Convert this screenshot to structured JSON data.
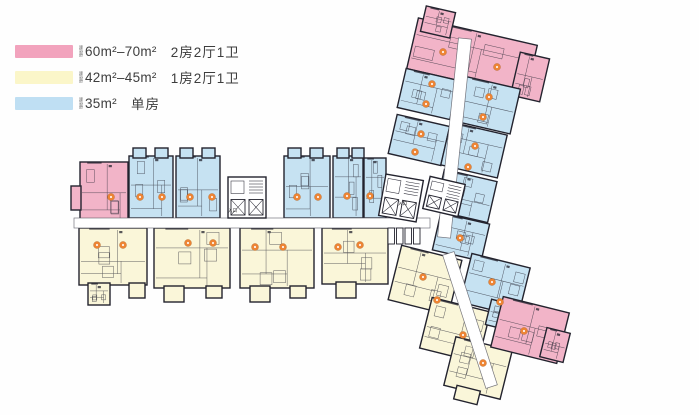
{
  "figure": {
    "kind": "residential-floor-plan",
    "background": "#fefefe"
  },
  "legend": {
    "prefix": "建筑面积",
    "items": [
      {
        "name": "two-bed",
        "swatch_color": "#f2a3bd",
        "area": "60m²–70m²",
        "desc": "2房2厅1卫"
      },
      {
        "name": "one-bed",
        "swatch_color": "#fbf6c9",
        "area": "42m²–45m²",
        "desc": "1房2厅1卫"
      },
      {
        "name": "studio",
        "swatch_color": "#bfdff3",
        "area": "35m²",
        "desc": "单房"
      }
    ]
  },
  "plan": {
    "wall_color": "#23232e",
    "detail_color": "#2c2c38",
    "corridor_color": "#ffffff",
    "marker_color": "#ed8434",
    "unit_colors": {
      "pink": "#f2b4c8",
      "yellow": "#faf6d9",
      "blue": "#c6e2f2",
      "white": "#ffffff"
    },
    "blocks": [
      {
        "k": "u",
        "c": "pink",
        "x": 80,
        "y": 162,
        "w": 48,
        "h": 63,
        "r": 0
      },
      {
        "k": "u",
        "c": "pink",
        "x": 71,
        "y": 186,
        "w": 10,
        "h": 24,
        "r": 0
      },
      {
        "k": "u",
        "c": "blue",
        "x": 129,
        "y": 156,
        "w": 44,
        "h": 62,
        "r": 0
      },
      {
        "k": "u",
        "c": "blue",
        "x": 133,
        "y": 148,
        "w": 13,
        "h": 10,
        "r": 0
      },
      {
        "k": "u",
        "c": "blue",
        "x": 155,
        "y": 148,
        "w": 13,
        "h": 10,
        "r": 0
      },
      {
        "k": "u",
        "c": "blue",
        "x": 176,
        "y": 156,
        "w": 44,
        "h": 62,
        "r": 0
      },
      {
        "k": "u",
        "c": "blue",
        "x": 180,
        "y": 148,
        "w": 13,
        "h": 10,
        "r": 0
      },
      {
        "k": "u",
        "c": "blue",
        "x": 202,
        "y": 148,
        "w": 13,
        "h": 10,
        "r": 0
      },
      {
        "k": "u",
        "c": "blue",
        "x": 284,
        "y": 156,
        "w": 46,
        "h": 62,
        "r": 0
      },
      {
        "k": "u",
        "c": "blue",
        "x": 288,
        "y": 148,
        "w": 13,
        "h": 10,
        "r": 0
      },
      {
        "k": "u",
        "c": "blue",
        "x": 310,
        "y": 148,
        "w": 13,
        "h": 10,
        "r": 0
      },
      {
        "k": "u",
        "c": "blue",
        "x": 333,
        "y": 156,
        "w": 30,
        "h": 62,
        "r": 0
      },
      {
        "k": "u",
        "c": "blue",
        "x": 337,
        "y": 148,
        "w": 12,
        "h": 10,
        "r": 0
      },
      {
        "k": "u",
        "c": "blue",
        "x": 352,
        "y": 148,
        "w": 12,
        "h": 10,
        "r": 0
      },
      {
        "k": "u",
        "c": "blue",
        "x": 364,
        "y": 158,
        "w": 22,
        "h": 60,
        "r": 0
      },
      {
        "k": "u",
        "c": "yellow",
        "x": 79,
        "y": 228,
        "w": 68,
        "h": 57,
        "r": 0
      },
      {
        "k": "u",
        "c": "yellow",
        "x": 88,
        "y": 283,
        "w": 22,
        "h": 22,
        "r": 0
      },
      {
        "k": "u",
        "c": "yellow",
        "x": 129,
        "y": 283,
        "w": 16,
        "h": 15,
        "r": 0
      },
      {
        "k": "u",
        "c": "yellow",
        "x": 154,
        "y": 228,
        "w": 76,
        "h": 60,
        "r": 0
      },
      {
        "k": "u",
        "c": "yellow",
        "x": 164,
        "y": 286,
        "w": 20,
        "h": 16,
        "r": 0
      },
      {
        "k": "u",
        "c": "yellow",
        "x": 206,
        "y": 286,
        "w": 16,
        "h": 12,
        "r": 0
      },
      {
        "k": "u",
        "c": "yellow",
        "x": 240,
        "y": 228,
        "w": 74,
        "h": 60,
        "r": 0
      },
      {
        "k": "u",
        "c": "yellow",
        "x": 250,
        "y": 286,
        "w": 20,
        "h": 16,
        "r": 0
      },
      {
        "k": "u",
        "c": "yellow",
        "x": 290,
        "y": 286,
        "w": 16,
        "h": 12,
        "r": 0
      },
      {
        "k": "u",
        "c": "yellow",
        "x": 322,
        "y": 228,
        "w": 66,
        "h": 56,
        "r": 0
      },
      {
        "k": "u",
        "c": "yellow",
        "x": 336,
        "y": 282,
        "w": 20,
        "h": 16,
        "r": 0
      },
      {
        "k": "u",
        "c": "pink",
        "x": 411,
        "y": 31,
        "w": 122,
        "h": 52,
        "r": 13
      },
      {
        "k": "u",
        "c": "pink",
        "x": 423,
        "y": 9,
        "w": 30,
        "h": 26,
        "r": 13
      },
      {
        "k": "u",
        "c": "pink",
        "x": 515,
        "y": 55,
        "w": 30,
        "h": 44,
        "r": 13
      },
      {
        "k": "u",
        "c": "blue",
        "x": 401,
        "y": 74,
        "w": 54,
        "h": 40,
        "r": 13
      },
      {
        "k": "u",
        "c": "blue",
        "x": 392,
        "y": 120,
        "w": 54,
        "h": 40,
        "r": 13
      },
      {
        "k": "u",
        "c": "blue",
        "x": 458,
        "y": 82,
        "w": 58,
        "h": 46,
        "r": 13
      },
      {
        "k": "u",
        "c": "blue",
        "x": 445,
        "y": 128,
        "w": 58,
        "h": 44,
        "r": 13
      },
      {
        "k": "u",
        "c": "blue",
        "x": 439,
        "y": 175,
        "w": 54,
        "h": 42,
        "r": 13
      },
      {
        "k": "u",
        "c": "blue",
        "x": 436,
        "y": 218,
        "w": 50,
        "h": 38,
        "r": 13
      },
      {
        "k": "u",
        "c": "yellow",
        "x": 394,
        "y": 252,
        "w": 62,
        "h": 56,
        "r": 14
      },
      {
        "k": "u",
        "c": "yellow",
        "x": 425,
        "y": 304,
        "w": 60,
        "h": 52,
        "r": 14
      },
      {
        "k": "u",
        "c": "yellow",
        "x": 449,
        "y": 343,
        "w": 58,
        "h": 50,
        "r": 14
      },
      {
        "k": "u",
        "c": "yellow",
        "x": 455,
        "y": 388,
        "w": 24,
        "h": 14,
        "r": 14
      },
      {
        "k": "u",
        "c": "blue",
        "x": 465,
        "y": 260,
        "w": 60,
        "h": 50,
        "r": 14
      },
      {
        "k": "u",
        "c": "blue",
        "x": 488,
        "y": 303,
        "w": 34,
        "h": 26,
        "r": 14
      },
      {
        "k": "u",
        "c": "pink",
        "x": 496,
        "y": 304,
        "w": 68,
        "h": 52,
        "r": 14
      },
      {
        "k": "u",
        "c": "pink",
        "x": 543,
        "y": 330,
        "w": 24,
        "h": 30,
        "r": 14
      },
      {
        "k": "cor",
        "c": "white",
        "x": 74,
        "y": 218,
        "w": 356,
        "h": 10,
        "r": 0
      },
      {
        "k": "cor",
        "c": "white",
        "x": 448,
        "y": 38,
        "w": 13,
        "h": 200,
        "r": 6
      },
      {
        "k": "cor",
        "c": "white",
        "x": 464,
        "y": 250,
        "w": 12,
        "h": 140,
        "r": -18
      },
      {
        "k": "core",
        "c": "white",
        "x": 228,
        "y": 177,
        "w": 38,
        "h": 41,
        "r": 0
      },
      {
        "k": "core",
        "c": "white",
        "x": 382,
        "y": 177,
        "w": 38,
        "h": 42,
        "r": 10
      },
      {
        "k": "core",
        "c": "white",
        "x": 426,
        "y": 180,
        "w": 36,
        "h": 33,
        "r": 13
      },
      {
        "k": "comb",
        "c": "white",
        "x": 388,
        "y": 228,
        "w": 34,
        "h": 16,
        "r": 0
      }
    ],
    "markers": [
      {
        "x": 111,
        "y": 197
      },
      {
        "x": 140,
        "y": 197
      },
      {
        "x": 162,
        "y": 197
      },
      {
        "x": 190,
        "y": 197
      },
      {
        "x": 212,
        "y": 197
      },
      {
        "x": 297,
        "y": 197
      },
      {
        "x": 318,
        "y": 197
      },
      {
        "x": 347,
        "y": 196
      },
      {
        "x": 370,
        "y": 196
      },
      {
        "x": 97,
        "y": 245
      },
      {
        "x": 123,
        "y": 245
      },
      {
        "x": 188,
        "y": 243
      },
      {
        "x": 213,
        "y": 243
      },
      {
        "x": 255,
        "y": 247
      },
      {
        "x": 283,
        "y": 247
      },
      {
        "x": 338,
        "y": 247
      },
      {
        "x": 360,
        "y": 245
      },
      {
        "x": 443,
        "y": 52
      },
      {
        "x": 497,
        "y": 67
      },
      {
        "x": 432,
        "y": 84
      },
      {
        "x": 426,
        "y": 104
      },
      {
        "x": 421,
        "y": 134
      },
      {
        "x": 415,
        "y": 152
      },
      {
        "x": 489,
        "y": 97
      },
      {
        "x": 483,
        "y": 117
      },
      {
        "x": 475,
        "y": 146
      },
      {
        "x": 468,
        "y": 167
      },
      {
        "x": 460,
        "y": 238
      },
      {
        "x": 423,
        "y": 277
      },
      {
        "x": 437,
        "y": 300
      },
      {
        "x": 463,
        "y": 335
      },
      {
        "x": 483,
        "y": 363
      },
      {
        "x": 492,
        "y": 282
      },
      {
        "x": 500,
        "y": 302
      },
      {
        "x": 524,
        "y": 331
      }
    ],
    "labels": [
      {
        "x": 228,
        "y": 212,
        "t": "入口"
      },
      {
        "x": 398,
        "y": 205,
        "t": "入口"
      }
    ]
  }
}
